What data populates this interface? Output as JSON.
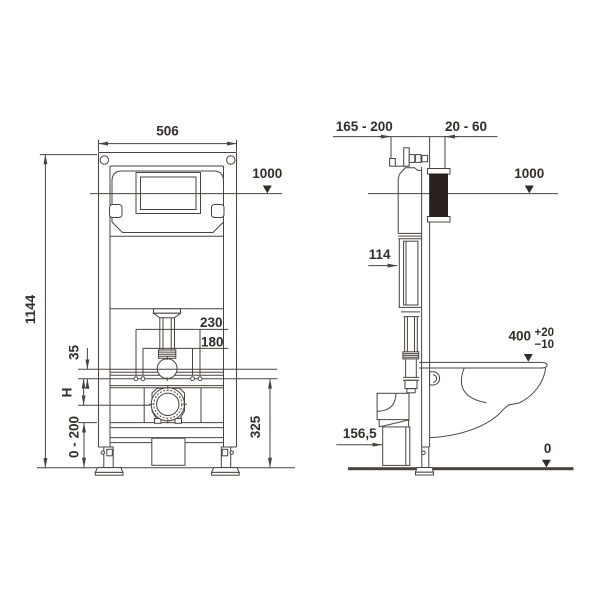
{
  "front_view": {
    "width": "506",
    "overall_height": "1144",
    "panel_height": "1000",
    "rod_spacing_outer": "230",
    "rod_spacing_inner": "180",
    "pipe_to_rods": "35",
    "variable_height": "H",
    "leg_adjustment": "0 - 200",
    "rod_height": "325"
  },
  "side_view": {
    "mounting_depth": "165 - 200",
    "wall_thickness": "20 - 60",
    "panel_height": "1000",
    "cistern_depth": "114",
    "bowl_height": "400",
    "bowl_tolerance_plus": "+20",
    "bowl_tolerance_minus": "−10",
    "outlet_height": "156,5",
    "floor_level": "0"
  }
}
